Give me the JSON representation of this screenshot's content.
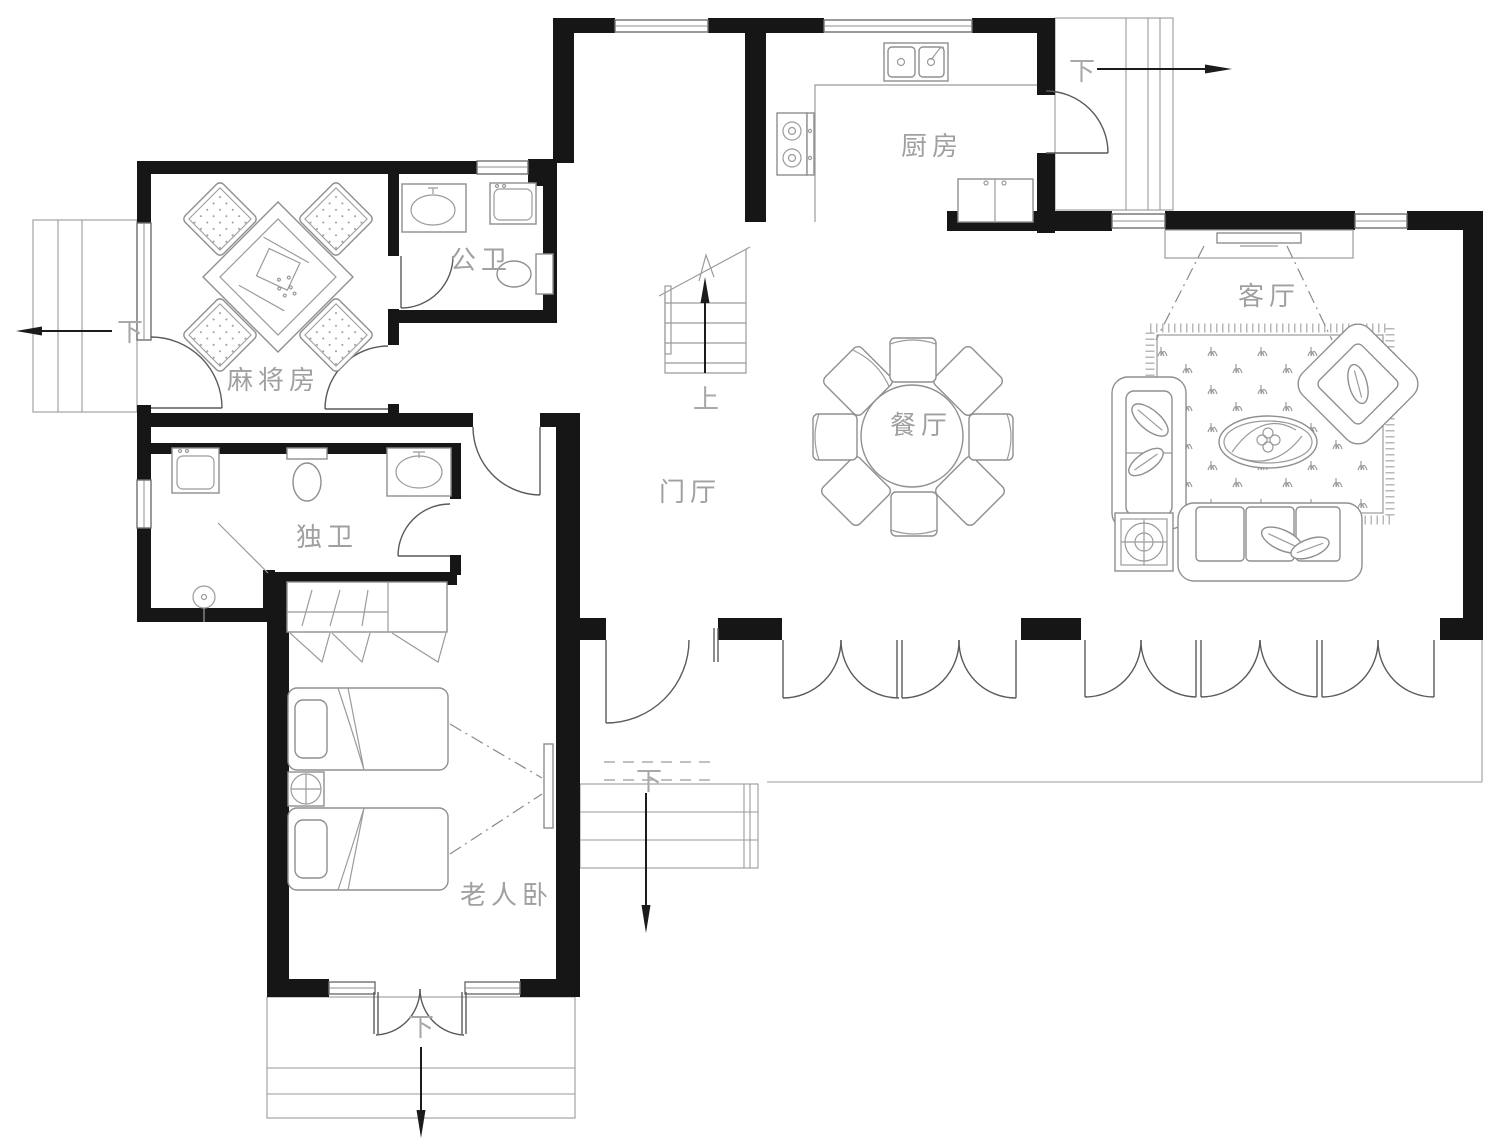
{
  "plan": {
    "rooms": {
      "kitchen": "厨房",
      "living_room": "客厅",
      "dining_room": "餐厅",
      "foyer": "门厅",
      "mahjong_room": "麻将房",
      "public_bathroom": "公卫",
      "private_bathroom": "独卫",
      "elder_bedroom": "老人卧"
    },
    "circulation": {
      "stairs_up": "上",
      "down_northeast": "下",
      "down_west": "下",
      "down_south": "下",
      "down_entrance": "下"
    },
    "colors": {
      "wall": "#161616",
      "furniture_line": "#8f8f8f",
      "label_text": "#a0a0a0",
      "arrow": "#1c1c1c",
      "background": "#ffffff"
    }
  }
}
